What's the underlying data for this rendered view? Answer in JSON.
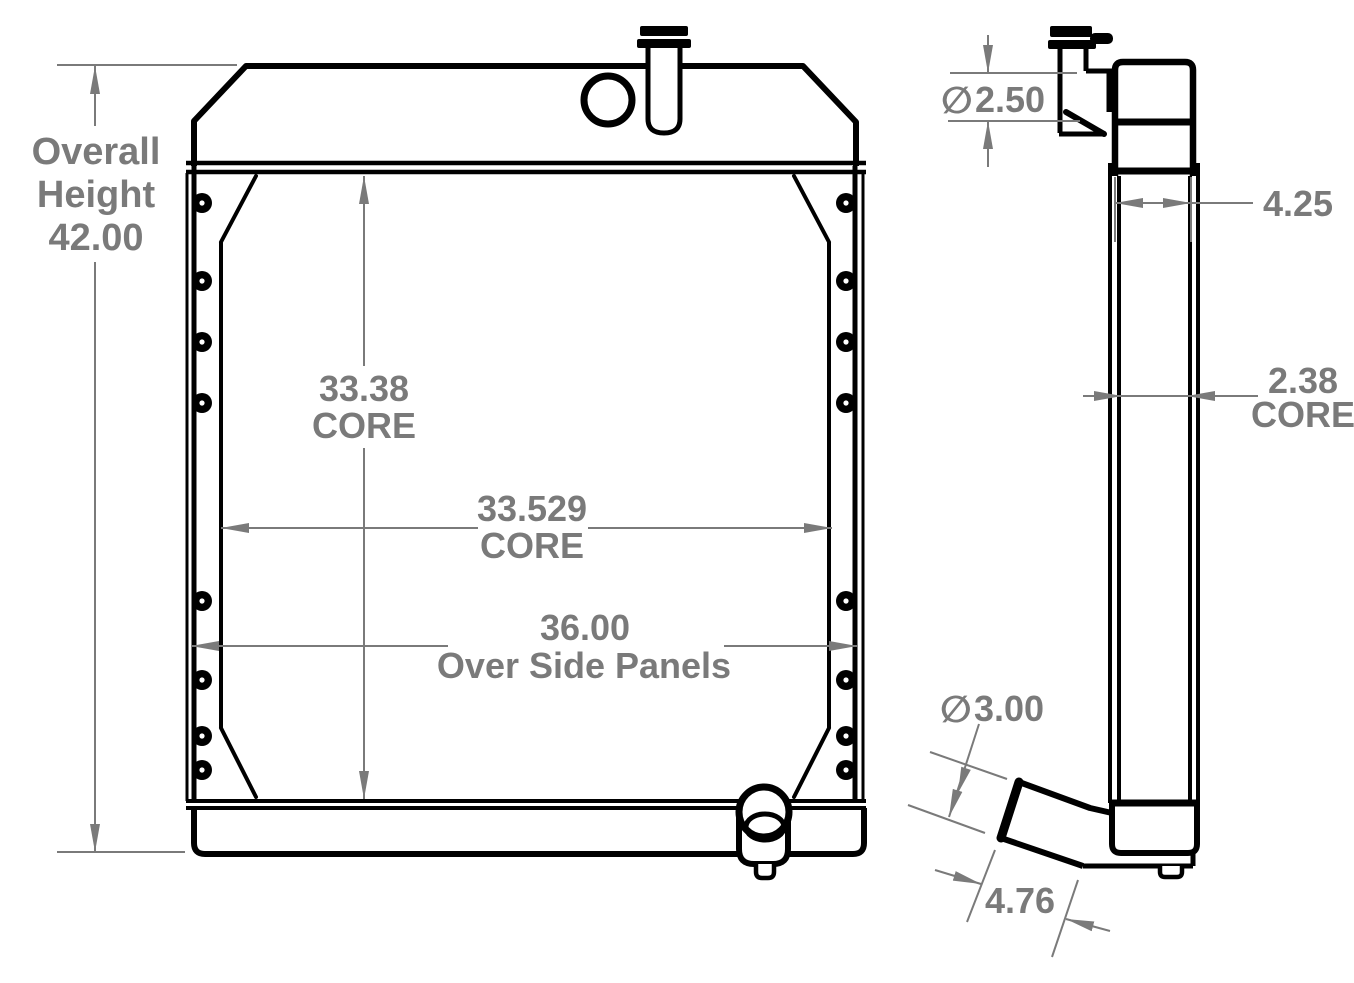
{
  "title": "Radiator dimensional drawing",
  "colors": {
    "line": "#000000",
    "dimension": "#7a7a7a",
    "background": "#ffffff"
  },
  "front_view": {
    "overall_height": {
      "line1": "Overall",
      "line2": "Height",
      "value": "42.00"
    },
    "core_height": {
      "value": "33.38",
      "unit_label": "CORE"
    },
    "core_width": {
      "value": "33.529",
      "unit_label": "CORE"
    },
    "overall_width": {
      "value": "36.00",
      "unit_label": "Over Side Panels"
    }
  },
  "side_view": {
    "inlet_diameter": {
      "symbol": "∅",
      "value": "2.50"
    },
    "top_tank_depth": {
      "value": "4.25"
    },
    "core_depth": {
      "value": "2.38",
      "unit_label": "CORE"
    },
    "outlet_diameter": {
      "symbol": "∅",
      "value": "3.00"
    },
    "outlet_length": {
      "value": "4.76"
    }
  }
}
